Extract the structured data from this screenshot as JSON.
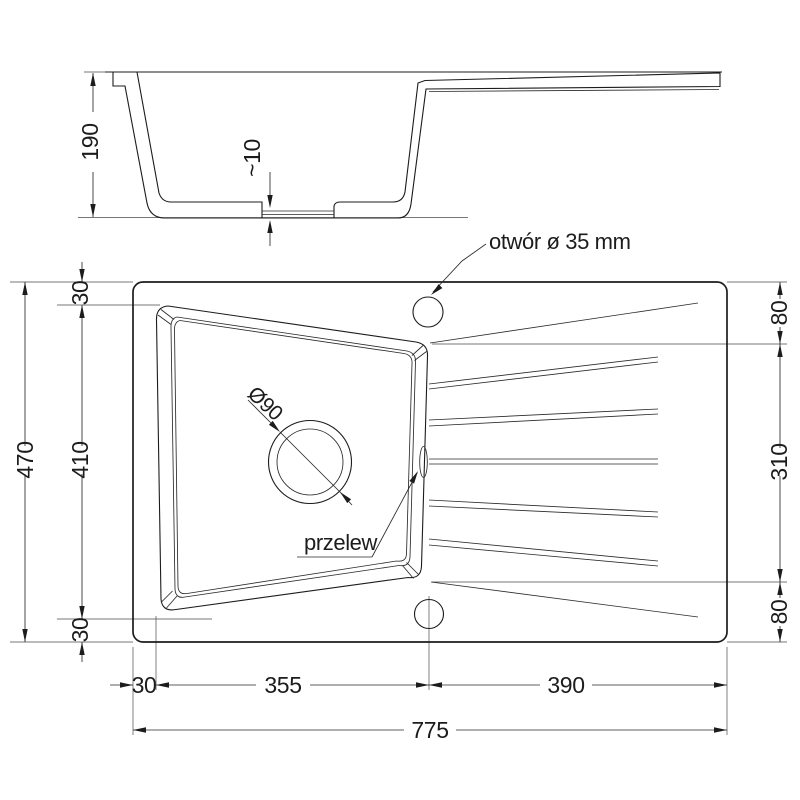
{
  "section": {
    "depth": "190",
    "floor_thickness": "~10"
  },
  "plan": {
    "total_width": "775",
    "bottom_segments": {
      "left": "30",
      "bowl": "355",
      "drainer": "390"
    },
    "total_height": "470",
    "left_segments": {
      "top": "30",
      "bowl": "410",
      "bottom": "30"
    },
    "right_segments": {
      "top": "80",
      "middle": "310",
      "bottom": "80"
    },
    "drain_label": "Ø90",
    "overflow_label": "przelew",
    "tap_hole_label": "otwór ø 35 mm"
  }
}
